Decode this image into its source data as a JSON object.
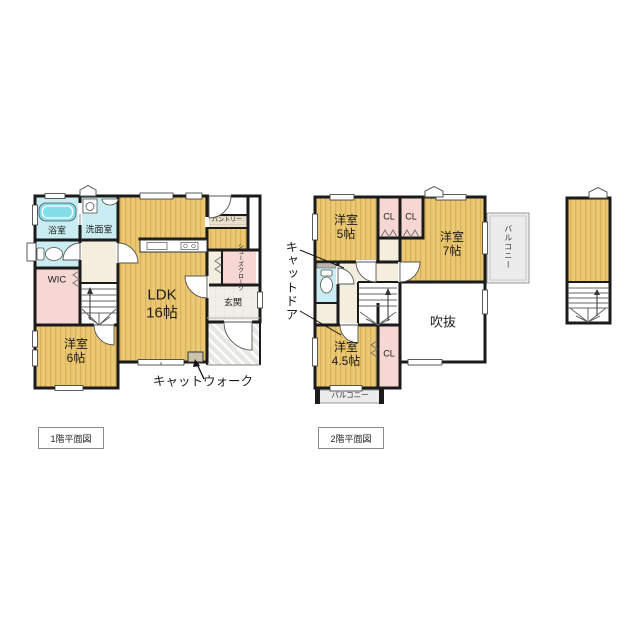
{
  "floor1": {
    "title": "1階平面図",
    "rooms": {
      "bath": "浴室",
      "washroom": "洗面室",
      "wic": "WIC",
      "ldk": "LDK\n16帖",
      "bedroom6": "洋室\n6帖",
      "genkan": "玄関",
      "shoes_closet": "シューズクローク",
      "pantry": "パントリー"
    },
    "annotations": {
      "catwalk": "キャットウォーク"
    }
  },
  "floor2": {
    "title": "2階平面図",
    "rooms": {
      "bedroom5": "洋室\n5帖",
      "closet_left": "CL",
      "closet_right": "CL",
      "bedroom7": "洋室\n7帖",
      "balcony_right": "バルコニー",
      "void": "吹抜",
      "bedroom45": "洋室\n4.5帖",
      "closet_bottom": "CL",
      "balcony_bottom": "バルコニー"
    },
    "annotations": {
      "catdoor": "キャットドア"
    }
  },
  "icons": [
    "bathtub-icon",
    "washing-machine-icon",
    "sink-icon",
    "toilet-icon",
    "kitchen-counter-icon",
    "stairs-icon",
    "door-swing-icon",
    "up-arrow-icon",
    "gable-mark-icon"
  ],
  "colors": {
    "wall": "#1b1b1b",
    "room_tatami": "#ebc873",
    "room_tatami_stripe": "#d9b157",
    "closet_pink": "#f6d7d3",
    "water_cyan": "#c9edf2",
    "bathtub_cyan": "#84dde8",
    "hall_beige": "#f3eedd",
    "balcony_gray": "#ececec",
    "porch_gray": "#e7e7e3",
    "text": "#1c1c1c"
  }
}
